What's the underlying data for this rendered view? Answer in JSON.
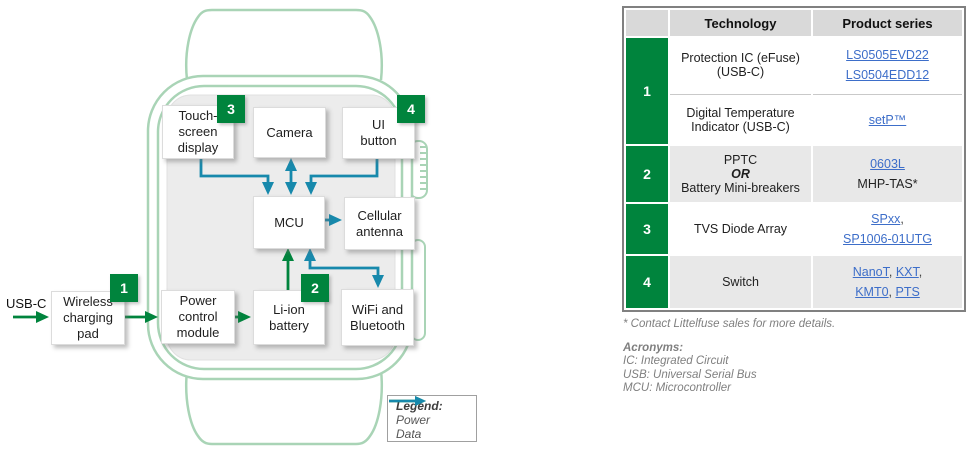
{
  "diagram": {
    "usb_label": "USB-C",
    "blocks": {
      "touch_display": {
        "label": "Touch-\nscreen\ndisplay",
        "badge": "3"
      },
      "camera": {
        "label": "Camera"
      },
      "ui_button": {
        "label": "UI\nbutton",
        "badge": "4"
      },
      "mcu": {
        "label": "MCU"
      },
      "cellular_antenna": {
        "label": "Cellular\nantenna"
      },
      "charging_pad": {
        "label": "Wireless\ncharging\npad",
        "badge": "1"
      },
      "power_module": {
        "label": "Power\ncontrol\nmodule"
      },
      "battery": {
        "label": "Li-ion\nbattery",
        "badge": "2"
      },
      "wifi": {
        "label": "WiFi and\nBluetooth"
      }
    },
    "connections": [
      {
        "from": "USB-C",
        "to": "Wireless charging pad",
        "type": "power"
      },
      {
        "from": "Wireless charging pad",
        "to": "Power control module",
        "type": "power"
      },
      {
        "from": "Power control module",
        "to": "Li-ion battery",
        "type": "power"
      },
      {
        "from": "Li-ion battery",
        "to": "MCU",
        "type": "power"
      },
      {
        "from": "Touch-screen display",
        "to": "MCU",
        "type": "data"
      },
      {
        "from": "Camera",
        "to": "MCU",
        "type": "data",
        "bidirectional": true
      },
      {
        "from": "UI button",
        "to": "MCU",
        "type": "data"
      },
      {
        "from": "MCU",
        "to": "Cellular antenna",
        "type": "data"
      },
      {
        "from": "MCU",
        "to": "WiFi and Bluetooth",
        "type": "data",
        "bidirectional": true
      }
    ],
    "legend": {
      "title": "Legend:",
      "power": "Power",
      "data": "Data"
    }
  },
  "table": {
    "header": {
      "technology": "Technology",
      "product_series": "Product series"
    },
    "row1": {
      "num": "1",
      "protection": {
        "tech": "Protection IC (eFuse)\n(USB-C)",
        "link1": "LS0505EVD22",
        "link2": "LS0504EDD12"
      },
      "temp": {
        "tech": "Digital Temperature\nIndicator (USB-C)",
        "link1": "setP™"
      }
    },
    "row2": {
      "num": "2",
      "tech1": "PPTC",
      "tech2": "OR",
      "tech3": "Battery Mini-breakers",
      "link1": "0603L",
      "plain1": "MHP-TAS*"
    },
    "row3": {
      "num": "3",
      "tech": "TVS Diode Array",
      "link1": "SPxx",
      "sep1": ",",
      "link2": "SP1006-01UTG"
    },
    "row4": {
      "num": "4",
      "tech": "Switch",
      "link1": "NanoT",
      "sep1": ", ",
      "link2": "KXT",
      "sep2": ",",
      "link3": "KMT0",
      "sep3": ", ",
      "link4": "PTS"
    }
  },
  "footnotes": {
    "contact": "* Contact Littelfuse sales for more details.",
    "acronyms_title": "Acronyms:",
    "acronyms": [
      "IC: Integrated Circuit",
      "USB: Universal Serial Bus",
      "MCU: Microcontroller"
    ]
  },
  "colors": {
    "power_arrow": "#00843d",
    "data_arrow": "#1789ac",
    "badge_green": "#00843d",
    "watch_outline": "#a9d4b6",
    "link_blue": "#3d6ec9",
    "table_header_bg": "#d9d9d9",
    "table_alt_row_bg": "#e8e8e8"
  }
}
